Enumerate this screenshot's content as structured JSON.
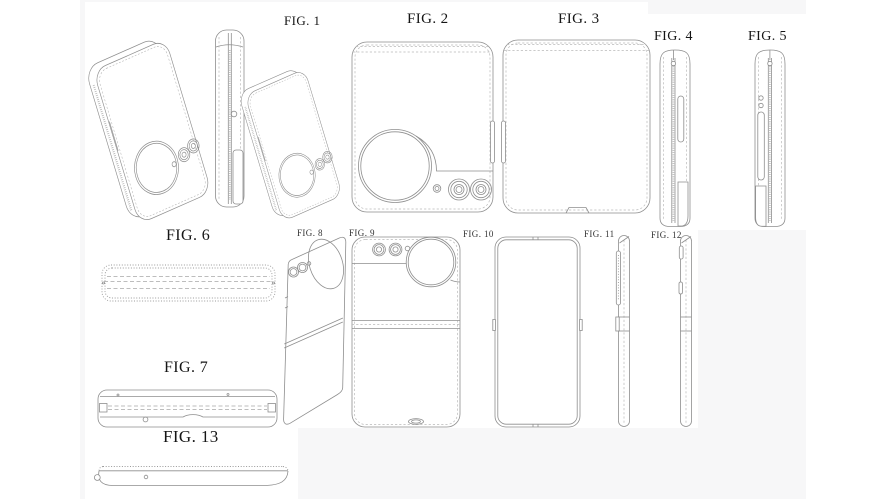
{
  "page": {
    "background": "#ffffff",
    "panel_background": "#f7f7f8",
    "tile_background": "#ffffff",
    "line_color": "#8e8e8e",
    "label_color": "#151515",
    "content": "patent-line-drawings-of-foldable-flip-phone"
  },
  "figures": [
    {
      "id": "fig1",
      "label": "FIG. 1"
    },
    {
      "id": "fig2",
      "label": "FIG. 2"
    },
    {
      "id": "fig3",
      "label": "FIG. 3"
    },
    {
      "id": "fig4",
      "label": "FIG. 4"
    },
    {
      "id": "fig5",
      "label": "FIG. 5"
    },
    {
      "id": "fig6",
      "label": "FIG. 6"
    },
    {
      "id": "fig7",
      "label": "FIG. 7"
    },
    {
      "id": "fig8",
      "label": "FIG. 8"
    },
    {
      "id": "fig9",
      "label": "FIG. 9"
    },
    {
      "id": "fig10",
      "label": "FIG. 10"
    },
    {
      "id": "fig11",
      "label": "FIG. 11"
    },
    {
      "id": "fig12",
      "label": "FIG. 12"
    },
    {
      "id": "fig13",
      "label": "FIG. 13"
    }
  ]
}
